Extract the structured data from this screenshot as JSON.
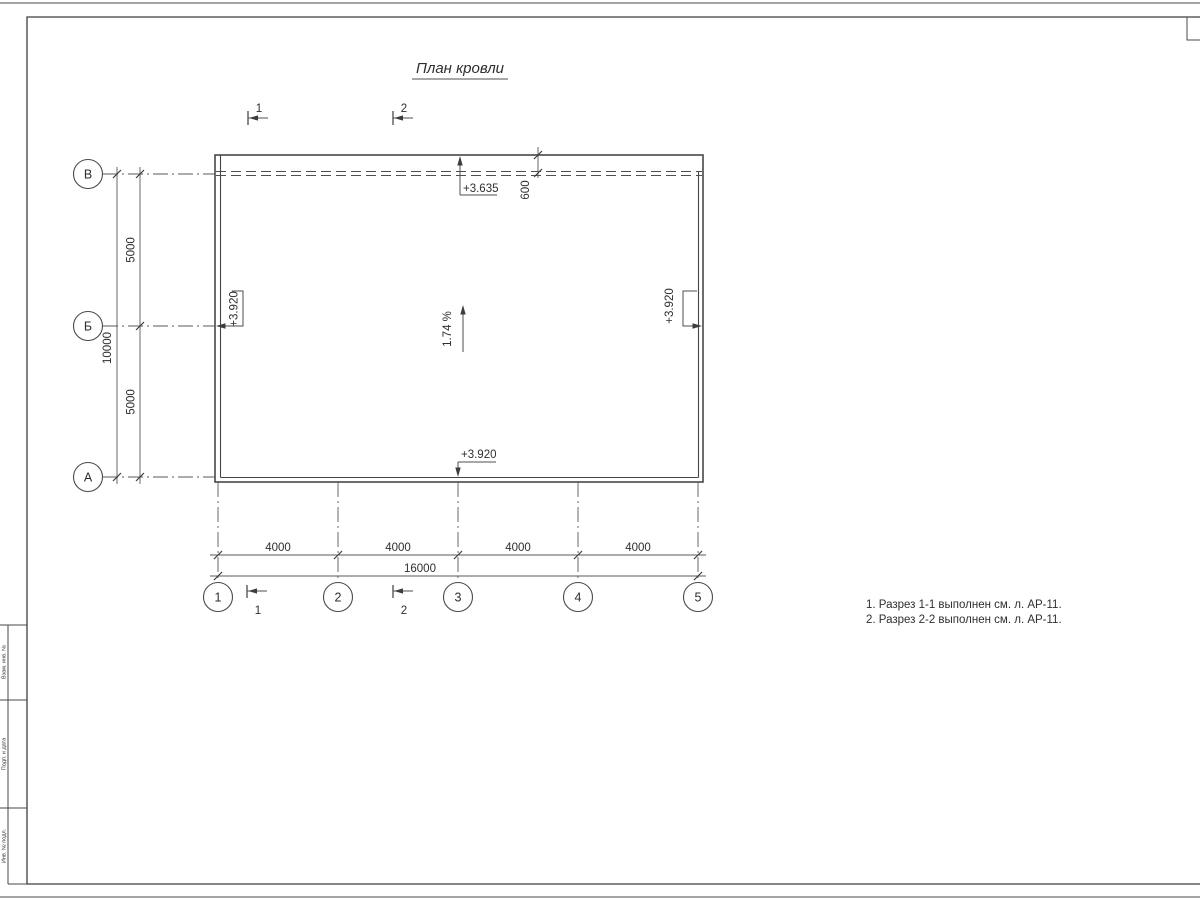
{
  "sheet": {
    "title": "План кровли",
    "notes": [
      "1. Разрез 1-1 выполнен см. л. АР-11.",
      "2. Разрез 2-2 выполнен см. л. АР-11."
    ],
    "stamp": {
      "c1": "Взам. инв. №",
      "c2": "Подп. и дата",
      "c3": "Инв. № подл."
    }
  },
  "plan": {
    "slope": "1.74 %",
    "elevations": {
      "top": "+3.635",
      "left": "+3.920",
      "right": "+3.920",
      "bottom": "+3.920"
    },
    "grid": {
      "cols": [
        "1",
        "2",
        "3",
        "4",
        "5"
      ],
      "rows": [
        "В",
        "Б",
        "А"
      ]
    },
    "dims": {
      "bay": [
        "4000",
        "4000",
        "4000",
        "4000"
      ],
      "total": "16000",
      "row": [
        "5000",
        "5000"
      ],
      "height": "10000",
      "eave": "600"
    },
    "sections": {
      "one": "1",
      "two": "2"
    }
  },
  "colors": {
    "line": "#4f4f4f",
    "text": "#2e2e2e",
    "paper": "#ffffff"
  }
}
